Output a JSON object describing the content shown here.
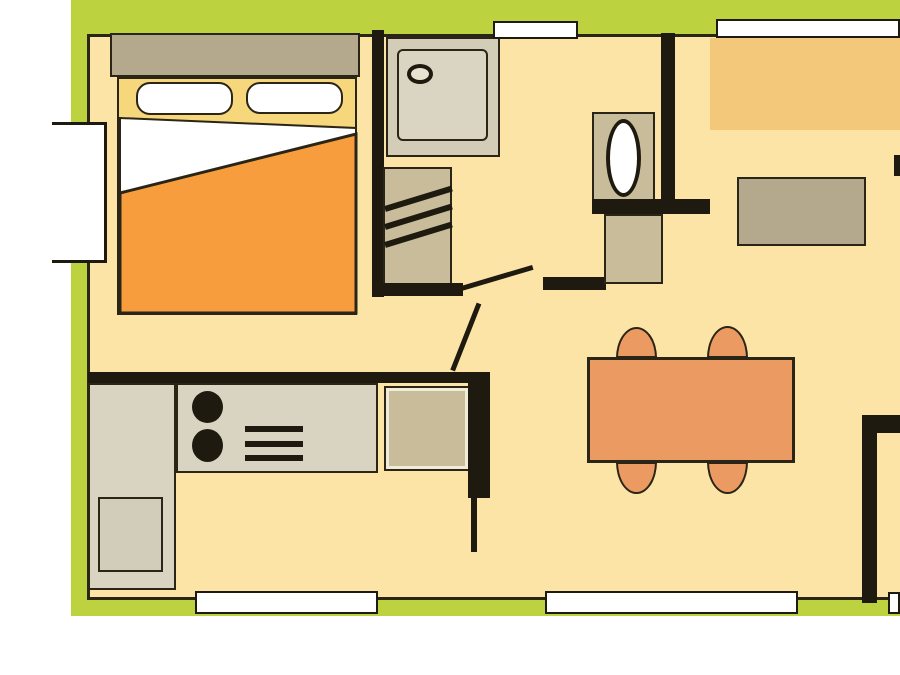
{
  "title": "mobile-home-floor-plan",
  "canvas": {
    "w": 900,
    "h": 675,
    "background": "#ffffff"
  },
  "palette": {
    "deck_green": "#bdd23f",
    "floor_cream": "#fce4a7",
    "wall_black": "#1e1a10",
    "outline_dark": "#2b2517",
    "furniture_tan": "#b4a98c",
    "cabinet_tan": "#c8bc9a",
    "counter_gray": "#d9d3c1",
    "shower_gray": "#d3ccb7",
    "bed_yellow": "#f6d77c",
    "blanket_orange": "#f89d3e",
    "table_salmon": "#eb9b61",
    "bench_amber": "#f4c87a",
    "window_white": "#ffffff"
  },
  "elements": [
    {
      "name": "deck-top-band",
      "type": "rect",
      "x": 71,
      "y": 0,
      "w": 829,
      "h": 34,
      "fill": "#bdd23f",
      "interactable": false
    },
    {
      "name": "deck-left-strip-upper",
      "type": "rect",
      "x": 71,
      "y": 0,
      "w": 16,
      "h": 122,
      "fill": "#bdd23f",
      "interactable": false
    },
    {
      "name": "deck-left-strip-lower",
      "type": "rect",
      "x": 71,
      "y": 263,
      "w": 16,
      "h": 353,
      "fill": "#bdd23f",
      "interactable": false
    },
    {
      "name": "deck-bottom-band",
      "type": "rect",
      "x": 71,
      "y": 600,
      "w": 829,
      "h": 16,
      "fill": "#bdd23f",
      "interactable": false
    },
    {
      "name": "floor",
      "type": "rect",
      "x": 87,
      "y": 34,
      "w": 813,
      "h": 566,
      "fill": "#fce4a7",
      "stroke": "#2b2517",
      "sw": 3,
      "sides": "ltb",
      "interactable": false
    },
    {
      "name": "bed-headboard",
      "type": "rect",
      "x": 110,
      "y": 33,
      "w": 250,
      "h": 44,
      "fill": "#b4a98c",
      "stroke": "#2b2517",
      "sw": 2,
      "interactable": false
    },
    {
      "name": "bed-base",
      "type": "rect",
      "x": 117,
      "y": 77,
      "w": 240,
      "h": 238,
      "fill": "#f6d77c",
      "stroke": "#2b2517",
      "sw": 2,
      "interactable": false
    },
    {
      "name": "bed-pillow-left",
      "type": "rect",
      "x": 136,
      "y": 82,
      "w": 97,
      "h": 33,
      "fill": "#ffffff",
      "stroke": "#2b2517",
      "sw": 2,
      "r": "14px",
      "interactable": false
    },
    {
      "name": "bed-pillow-right",
      "type": "rect",
      "x": 246,
      "y": 82,
      "w": 97,
      "h": 32,
      "fill": "#ffffff",
      "stroke": "#2b2517",
      "sw": 2,
      "r": "14px",
      "interactable": false
    },
    {
      "name": "bed-sheet",
      "type": "polygon",
      "points": [
        [
          120,
          118
        ],
        [
          356,
          128
        ],
        [
          356,
          135
        ],
        [
          120,
          195
        ]
      ],
      "fill": "#ffffff",
      "stroke": "#2b2517",
      "sw": 2,
      "interactable": false
    },
    {
      "name": "bed-blanket",
      "type": "polygon",
      "points": [
        [
          120,
          193
        ],
        [
          356,
          134
        ],
        [
          356,
          313
        ],
        [
          120,
          313
        ]
      ],
      "fill": "#f89d3e",
      "stroke": "#2b2517",
      "sw": 3,
      "interactable": false
    },
    {
      "name": "wall-shower-left",
      "type": "rect",
      "x": 372,
      "y": 30,
      "w": 12,
      "h": 267,
      "fill": "#1e1a10",
      "interactable": false
    },
    {
      "name": "shower-tray",
      "type": "rect",
      "x": 386,
      "y": 37,
      "w": 114,
      "h": 120,
      "fill": "#d3ccb7",
      "stroke": "#2b2517",
      "sw": 2,
      "interactable": false
    },
    {
      "name": "shower-basin",
      "type": "rect",
      "x": 397,
      "y": 49,
      "w": 91,
      "h": 92,
      "fill": "#dad4c2",
      "stroke": "#2b2517",
      "sw": 2,
      "r": "6px",
      "interactable": false
    },
    {
      "name": "shower-drain",
      "type": "ellipse",
      "x": 407,
      "y": 64,
      "w": 26,
      "h": 20,
      "fill": "#e8e3d1",
      "stroke": "#1e1a10",
      "sw": 4,
      "interactable": false
    },
    {
      "name": "wardrobe",
      "type": "rect",
      "x": 383,
      "y": 167,
      "w": 69,
      "h": 123,
      "fill": "#c8bc9a",
      "stroke": "#2b2517",
      "sw": 2,
      "interactable": false
    },
    {
      "name": "wardrobe-stripe-1",
      "type": "line",
      "x": 385,
      "y": 209,
      "len": 70,
      "th": 6,
      "angle": -17,
      "color": "#1e1a10",
      "interactable": false
    },
    {
      "name": "wardrobe-stripe-2",
      "type": "line",
      "x": 385,
      "y": 227,
      "len": 70,
      "th": 6,
      "angle": -17,
      "color": "#1e1a10",
      "interactable": false
    },
    {
      "name": "wardrobe-stripe-3",
      "type": "line",
      "x": 385,
      "y": 245,
      "len": 70,
      "th": 6,
      "angle": -17,
      "color": "#1e1a10",
      "interactable": false
    },
    {
      "name": "wall-wardrobe-bottom",
      "type": "rect",
      "x": 372,
      "y": 283,
      "w": 91,
      "h": 13,
      "fill": "#1e1a10",
      "interactable": false
    },
    {
      "name": "door-bathroom-leaf",
      "type": "line",
      "x": 458,
      "y": 289,
      "len": 78,
      "th": 5,
      "angle": -16.5,
      "color": "#1e1a10",
      "interactable": false
    },
    {
      "name": "door-bedroom-leaf",
      "type": "line",
      "x": 479,
      "y": 303,
      "len": 72,
      "th": 5,
      "angle": 111.5,
      "color": "#1e1a10",
      "interactable": false
    },
    {
      "name": "wall-hallway",
      "type": "rect",
      "x": 543,
      "y": 277,
      "w": 63,
      "h": 13,
      "fill": "#1e1a10",
      "interactable": false
    },
    {
      "name": "wall-wc-right",
      "type": "rect",
      "x": 661,
      "y": 33,
      "w": 14,
      "h": 181,
      "fill": "#1e1a10",
      "interactable": false
    },
    {
      "name": "toilet-base",
      "type": "rect",
      "x": 592,
      "y": 112,
      "w": 63,
      "h": 90,
      "fill": "#c8bc9a",
      "stroke": "#2b2517",
      "sw": 2,
      "interactable": false
    },
    {
      "name": "toilet-bowl",
      "type": "ellipse",
      "x": 606,
      "y": 119,
      "w": 35,
      "h": 78,
      "fill": "#ffffff",
      "stroke": "#1e1a10",
      "sw": 4,
      "interactable": false
    },
    {
      "name": "wall-wc-bottom",
      "type": "rect",
      "x": 592,
      "y": 199,
      "w": 118,
      "h": 15,
      "fill": "#1e1a10",
      "interactable": false
    },
    {
      "name": "wc-vanity",
      "type": "rect",
      "x": 604,
      "y": 214,
      "w": 59,
      "h": 70,
      "fill": "#c8bc9a",
      "stroke": "#2b2517",
      "sw": 2,
      "interactable": false
    },
    {
      "name": "bench-seat",
      "type": "rect",
      "x": 710,
      "y": 38,
      "w": 190,
      "h": 92,
      "fill": "#f4c87a",
      "interactable": false
    },
    {
      "name": "sideboard",
      "type": "rect",
      "x": 737,
      "y": 177,
      "w": 129,
      "h": 69,
      "fill": "#b4a98c",
      "stroke": "#2b2517",
      "sw": 2,
      "interactable": false
    },
    {
      "name": "chair-top-left",
      "type": "rect",
      "x": 616,
      "y": 327,
      "w": 41,
      "h": 31,
      "fill": "#eb9b61",
      "stroke": "#2b2517",
      "sw": 2.5,
      "r": "50% 50% 0 0 / 100% 100% 0 0",
      "interactable": false
    },
    {
      "name": "chair-top-right",
      "type": "rect",
      "x": 707,
      "y": 326,
      "w": 41,
      "h": 32,
      "fill": "#eb9b61",
      "stroke": "#2b2517",
      "sw": 2.5,
      "r": "50% 50% 0 0 / 100% 100% 0 0",
      "interactable": false
    },
    {
      "name": "chair-bottom-left",
      "type": "rect",
      "x": 616,
      "y": 462,
      "w": 41,
      "h": 32,
      "fill": "#eb9b61",
      "stroke": "#2b2517",
      "sw": 2.5,
      "r": "0 0 50% 50% / 0 0 100% 100%",
      "interactable": false
    },
    {
      "name": "chair-bottom-right",
      "type": "rect",
      "x": 707,
      "y": 462,
      "w": 41,
      "h": 32,
      "fill": "#eb9b61",
      "stroke": "#2b2517",
      "sw": 2.5,
      "r": "0 0 50% 50% / 0 0 100% 100%",
      "interactable": false
    },
    {
      "name": "dining-table",
      "type": "rect",
      "x": 587,
      "y": 357,
      "w": 208,
      "h": 106,
      "fill": "#eb9b61",
      "stroke": "#2b2517",
      "sw": 3,
      "interactable": false
    },
    {
      "name": "kitchen-counter-vertical",
      "type": "rect",
      "x": 88,
      "y": 383,
      "w": 88,
      "h": 207,
      "fill": "#d9d3c1",
      "stroke": "#2b2517",
      "sw": 2,
      "interactable": false
    },
    {
      "name": "kitchen-counter-horizontal",
      "type": "rect",
      "x": 176,
      "y": 383,
      "w": 202,
      "h": 90,
      "fill": "#d9d3c1",
      "stroke": "#2b2517",
      "sw": 2,
      "interactable": false
    },
    {
      "name": "kitchen-fridge",
      "type": "rect",
      "x": 98,
      "y": 497,
      "w": 65,
      "h": 75,
      "fill": "#d2ccba",
      "stroke": "#2b2517",
      "sw": 2,
      "interactable": false
    },
    {
      "name": "hob-burner-1",
      "type": "ellipse",
      "x": 192,
      "y": 391,
      "w": 31,
      "h": 32,
      "fill": "#1e1a10",
      "interactable": false
    },
    {
      "name": "hob-burner-2",
      "type": "ellipse",
      "x": 192,
      "y": 429,
      "w": 31,
      "h": 33,
      "fill": "#1e1a10",
      "interactable": false
    },
    {
      "name": "hob-grill-bar-1",
      "type": "rect",
      "x": 245,
      "y": 426,
      "w": 58,
      "h": 6,
      "fill": "#1e1a10",
      "interactable": false
    },
    {
      "name": "hob-grill-bar-2",
      "type": "rect",
      "x": 245,
      "y": 441,
      "w": 58,
      "h": 6,
      "fill": "#1e1a10",
      "interactable": false
    },
    {
      "name": "hob-grill-bar-3",
      "type": "rect",
      "x": 245,
      "y": 455,
      "w": 58,
      "h": 6,
      "fill": "#1e1a10",
      "interactable": false
    },
    {
      "name": "kitchen-sink-unit",
      "type": "rect",
      "x": 384,
      "y": 386,
      "w": 86,
      "h": 85,
      "fill": "#c8bc9a",
      "stroke": "#2b2517",
      "sw": 2,
      "inset": {
        "w": 3,
        "color": "#f1ecd9"
      },
      "interactable": false
    },
    {
      "name": "wall-kitchen-bar",
      "type": "rect",
      "x": 88,
      "y": 372,
      "w": 402,
      "h": 11,
      "fill": "#1e1a10",
      "interactable": false
    },
    {
      "name": "wall-kitchen-stub",
      "type": "rect",
      "x": 468,
      "y": 372,
      "w": 22,
      "h": 126,
      "fill": "#1e1a10",
      "interactable": false
    },
    {
      "name": "wall-kitchen-thin",
      "type": "rect",
      "x": 471,
      "y": 498,
      "w": 6,
      "h": 54,
      "fill": "#1e1a10",
      "interactable": false
    },
    {
      "name": "wall-right-doorway-bar",
      "type": "rect",
      "x": 862,
      "y": 415,
      "w": 38,
      "h": 18,
      "fill": "#1e1a10",
      "interactable": false
    },
    {
      "name": "wall-right-doorway-vert",
      "type": "rect",
      "x": 862,
      "y": 415,
      "w": 15,
      "h": 188,
      "fill": "#1e1a10",
      "interactable": false
    },
    {
      "name": "wall-right-edge-stub",
      "type": "rect",
      "x": 894,
      "y": 155,
      "w": 6,
      "h": 21,
      "fill": "#1e1a10",
      "interactable": false
    },
    {
      "name": "window-top-small",
      "type": "rect",
      "x": 493,
      "y": 21,
      "w": 85,
      "h": 18,
      "fill": "#ffffff",
      "stroke": "#1e1a10",
      "sw": 2,
      "interactable": false
    },
    {
      "name": "window-top-large",
      "type": "rect",
      "x": 716,
      "y": 19,
      "w": 184,
      "h": 19,
      "fill": "#ffffff",
      "stroke": "#1e1a10",
      "sw": 2,
      "interactable": false
    },
    {
      "name": "window-left",
      "type": "rect",
      "x": 52,
      "y": 122,
      "w": 55,
      "h": 141,
      "fill": "#ffffff",
      "stroke": "#1e1a10",
      "sw": 3,
      "sides": "trb",
      "interactable": false
    },
    {
      "name": "window-bottom-1",
      "type": "rect",
      "x": 195,
      "y": 591,
      "w": 183,
      "h": 23,
      "fill": "#ffffff",
      "stroke": "#1e1a10",
      "sw": 2,
      "interactable": false
    },
    {
      "name": "door-bottom-entry",
      "type": "rect",
      "x": 545,
      "y": 591,
      "w": 253,
      "h": 23,
      "fill": "#ffffff",
      "stroke": "#1e1a10",
      "sw": 2,
      "interactable": false
    },
    {
      "name": "window-bottom-2",
      "type": "rect",
      "x": 888,
      "y": 592,
      "w": 12,
      "h": 22,
      "fill": "#ffffff",
      "stroke": "#1e1a10",
      "sw": 2,
      "interactable": false
    }
  ]
}
